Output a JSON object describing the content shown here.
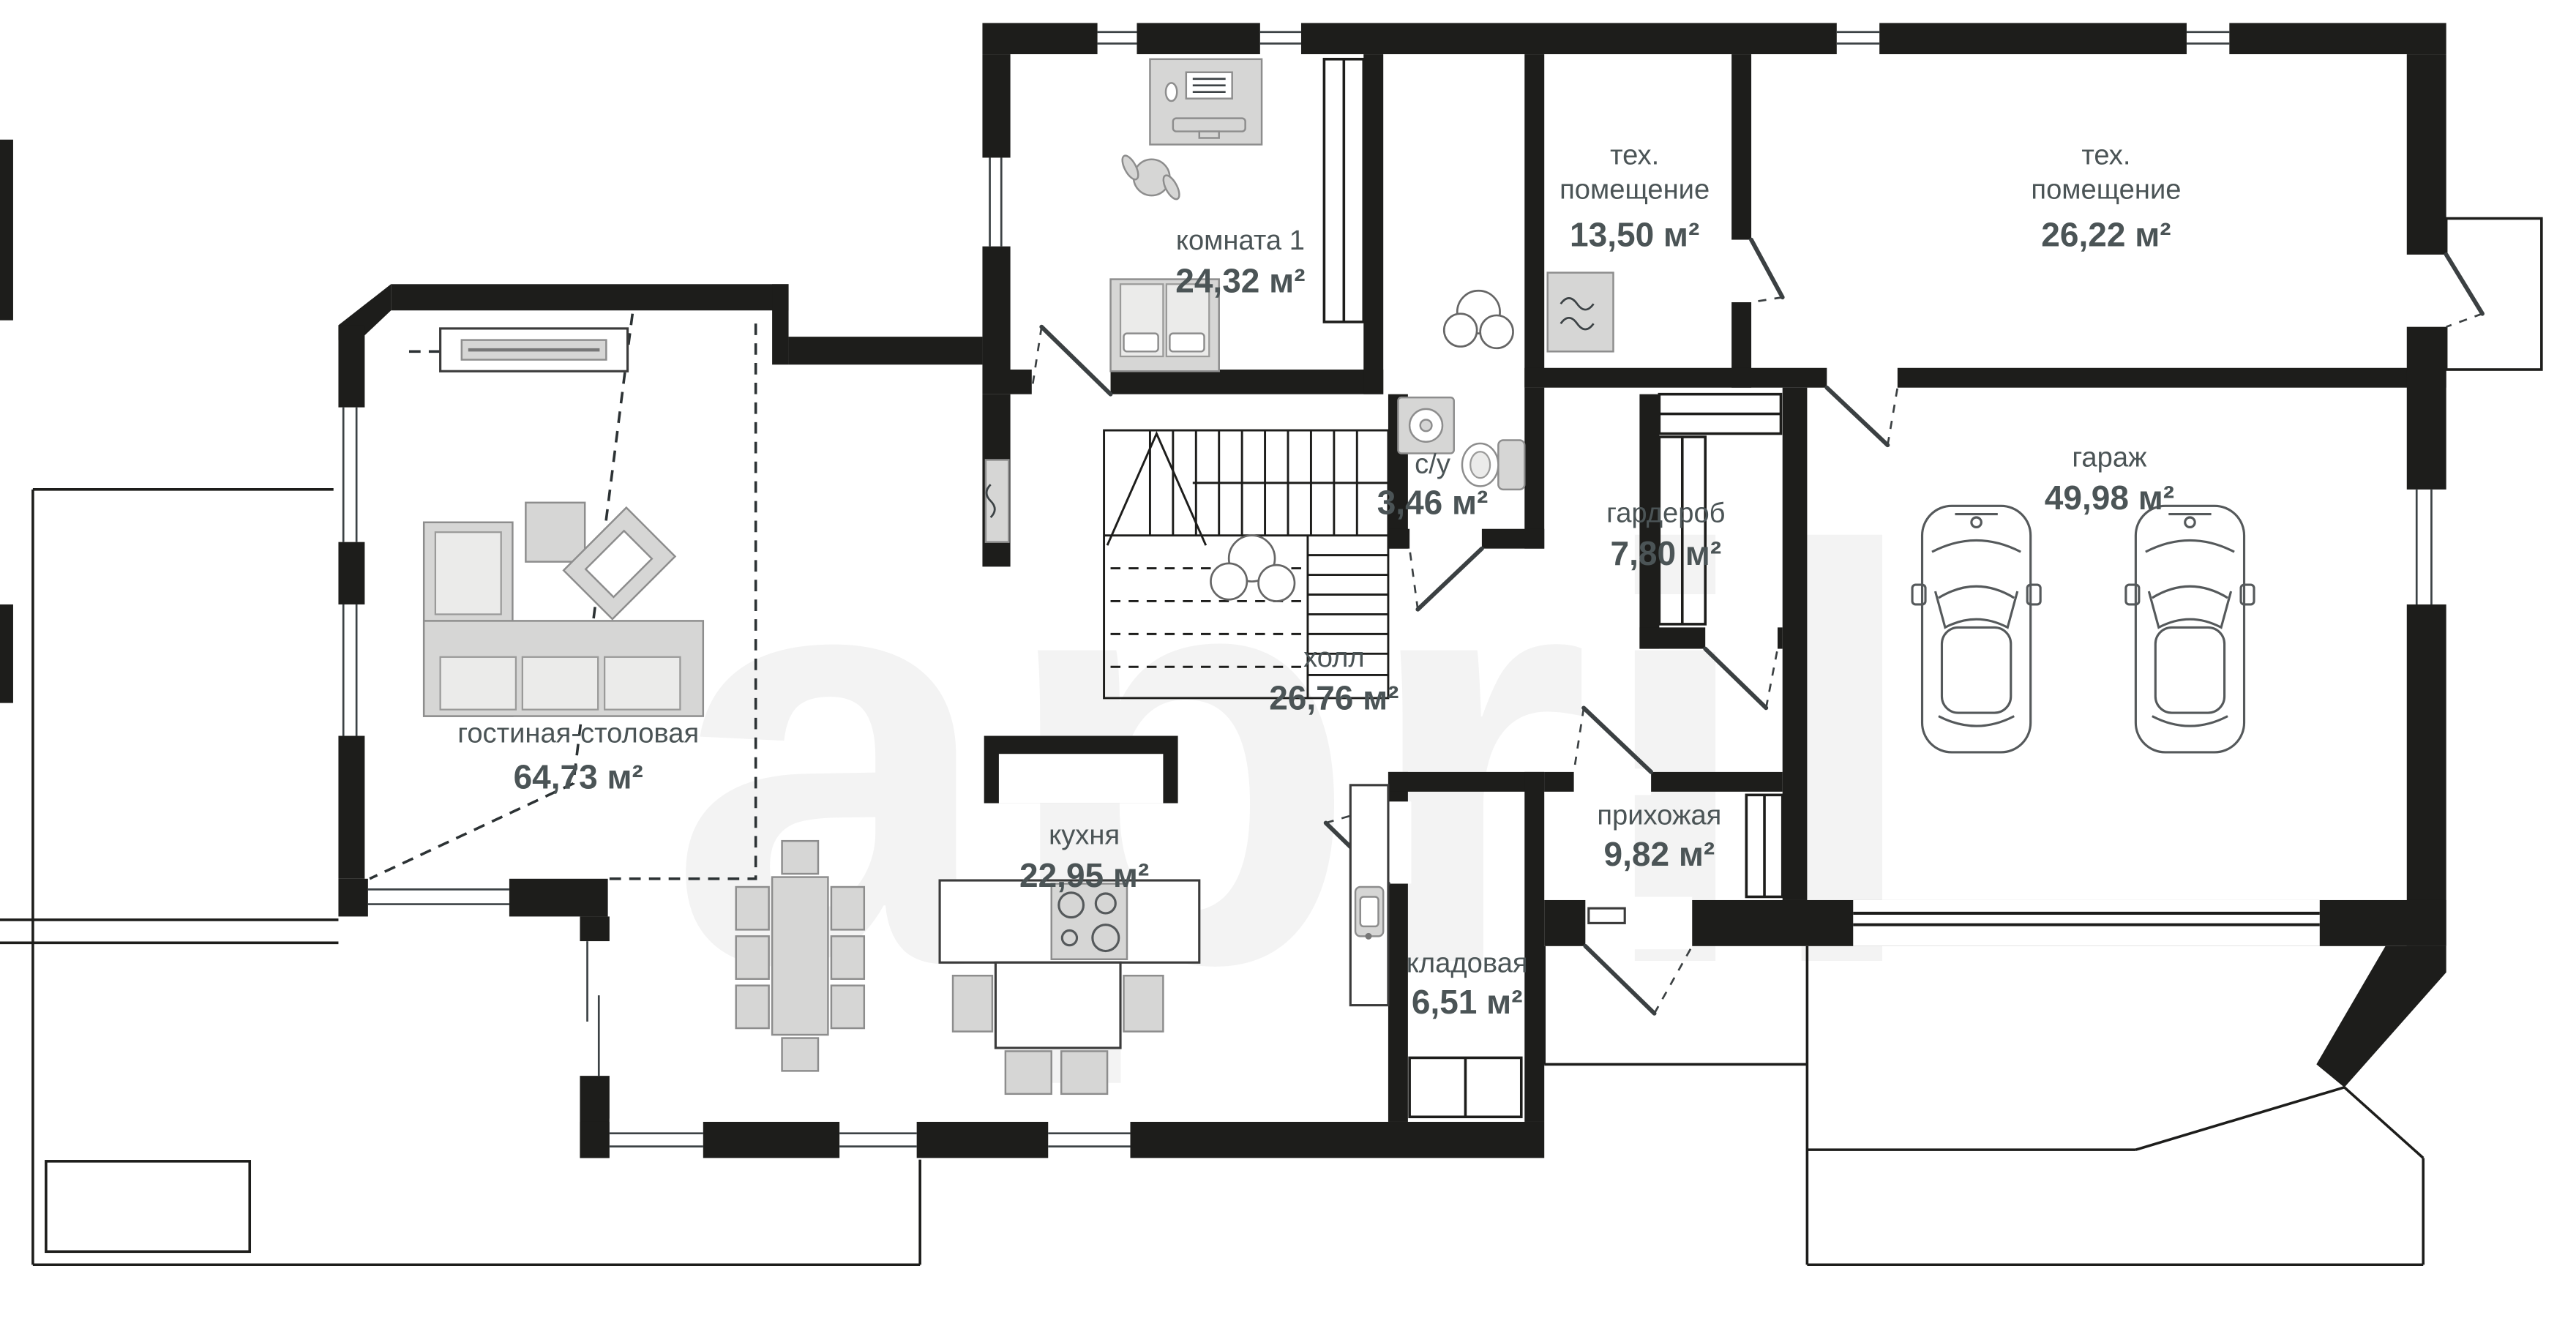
{
  "watermark": "april",
  "colors": {
    "wall": "#1d1d1b",
    "label": "#4b5456",
    "furniture_fill": "#d6d6d5",
    "furniture_stroke": "#8d8d8d",
    "watermark": "#f3f3f3",
    "background": "#ffffff"
  },
  "rooms": [
    {
      "name": "комната 1",
      "area": "24,32 м²"
    },
    {
      "name_lines": [
        "тех.",
        "помещение"
      ],
      "area": "13,50 м²"
    },
    {
      "name_lines": [
        "тех.",
        "помещение"
      ],
      "area": "26,22 м²"
    },
    {
      "name": "гараж",
      "area": "49,98 м²"
    },
    {
      "name": "гостиная-столовая",
      "area": "64,73 м²"
    },
    {
      "name": "холл",
      "area": "26,76 м²"
    },
    {
      "name": "с/у",
      "area": "3,46 м²"
    },
    {
      "name": "гардероб",
      "area": "7,80 м²"
    },
    {
      "name": "кухня",
      "area": "22,95 м²"
    },
    {
      "name": "прихожая",
      "area": "9,82 м²"
    },
    {
      "name": "кладовая",
      "area": "6,51 м²"
    }
  ],
  "furniture_icons": [
    "double-bed",
    "desk",
    "office-chair",
    "wardrobe-rack",
    "plant",
    "stairs",
    "fireplace",
    "corner-sofa",
    "armchair",
    "ottoman",
    "dining-table",
    "kitchen-island",
    "cooktop",
    "kitchen-counter",
    "sink",
    "pantry-shelves",
    "coat-rack",
    "washing-machine",
    "toilet",
    "boiler",
    "radiator",
    "car",
    "garage-door"
  ]
}
